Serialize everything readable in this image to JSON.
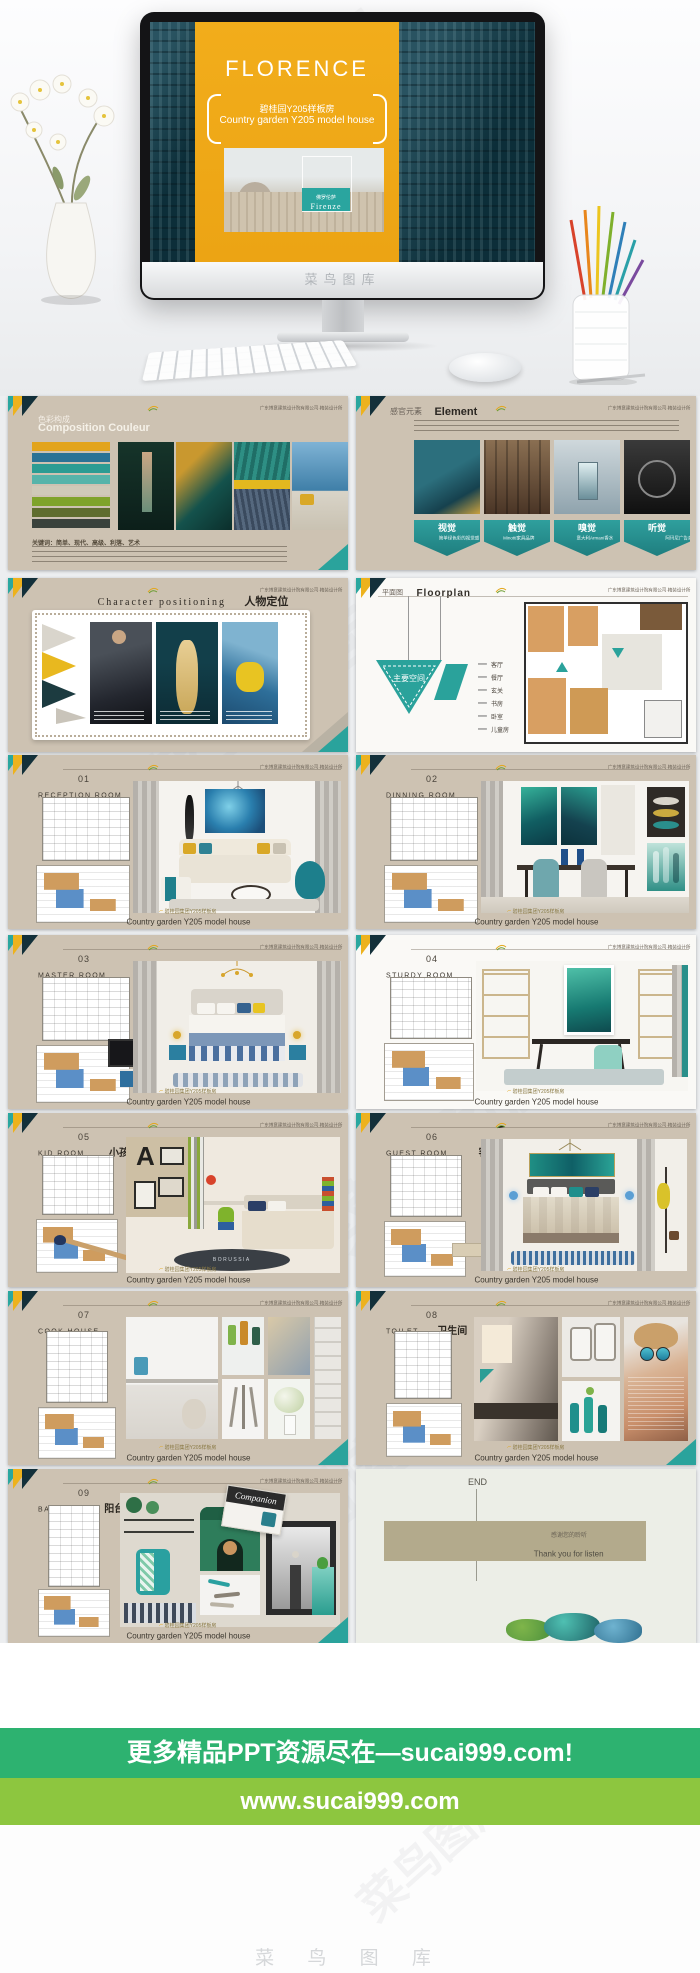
{
  "watermarks": {
    "chin": "菜鸟图库",
    "diag": "菜鸟图库",
    "bottom": "菜 鸟 图 库"
  },
  "company": "广东博意建筑设计院有限公司·精装设计所",
  "hero": {
    "title": "FLORENCE",
    "subtitle_cn": "碧桂园Y205样板房",
    "subtitle_en": "Country garden Y205 model house",
    "photo_label_cn": "佛罗伦萨",
    "photo_label_en": "Firenze"
  },
  "s1": {
    "title_cn": "色彩构成",
    "title_en": "Composition Couleur",
    "keywords": "关键词：简单、现代、高级、利落、艺术",
    "palette": [
      "#e2a41c",
      "#2a7295",
      "#2b9c93",
      "#56b4aa",
      "#cfc9b8",
      "#7fa32a",
      "#5f6d2e",
      "#3a423c"
    ]
  },
  "s2": {
    "title_cn": "感官元素",
    "title_en": "Element",
    "senses": [
      {
        "name": "视觉",
        "desc": "简单绿色彩的视觉感"
      },
      {
        "name": "触觉",
        "desc": "Minotti家具品牌"
      },
      {
        "name": "嗅觉",
        "desc": "意大利Armani香水"
      },
      {
        "name": "听觉",
        "desc": "阿玛尼广告音乐(Any Other World)"
      }
    ]
  },
  "s3": {
    "title_en": "Character positioning",
    "title_cn": "人物定位"
  },
  "s4": {
    "title_cn": "平面图",
    "title_en": "Floorplan",
    "label": "主要空间",
    "rooms": [
      "客厅",
      "餐厅",
      "玄关",
      "书房",
      "卧室",
      "儿童房"
    ]
  },
  "rooms": {
    "r1": {
      "num": "01",
      "en": "RECEPTION ROOM",
      "cn": "客厅"
    },
    "r2": {
      "num": "02",
      "en": "DINNING ROOM",
      "cn": "餐厅"
    },
    "r3": {
      "num": "03",
      "en": "MASTER ROOM",
      "cn": "主卧"
    },
    "r4": {
      "num": "04",
      "en": "STURDY ROOM",
      "cn": "书房"
    },
    "r5": {
      "num": "05",
      "en": "KID ROOM",
      "cn": "小孩房"
    },
    "r6": {
      "num": "06",
      "en": "GUEST ROOM",
      "cn": "客卧"
    },
    "r7": {
      "num": "07",
      "en": "COOK HOUSE",
      "cn": "厨房"
    },
    "r8": {
      "num": "08",
      "en": "TOILET",
      "cn": "卫生间"
    },
    "r9": {
      "num": "09",
      "en": "BALCONY",
      "cn": "阳台"
    }
  },
  "slide_footer": {
    "cn": "碧桂园集团Y205样板房",
    "en": "Country garden Y205 model house"
  },
  "s9_extra": {
    "letter": "A",
    "rug": "BORUSSIA"
  },
  "s13_extra": {
    "magazine": "Companion"
  },
  "end": {
    "label": "END",
    "thanks_cn": "感谢您的聆听",
    "thanks_en": "Thank you for listen"
  },
  "banners": {
    "line1": "更多精品PPT资源尽在—sucai999.com!",
    "line2": "www.sucai999.com"
  }
}
